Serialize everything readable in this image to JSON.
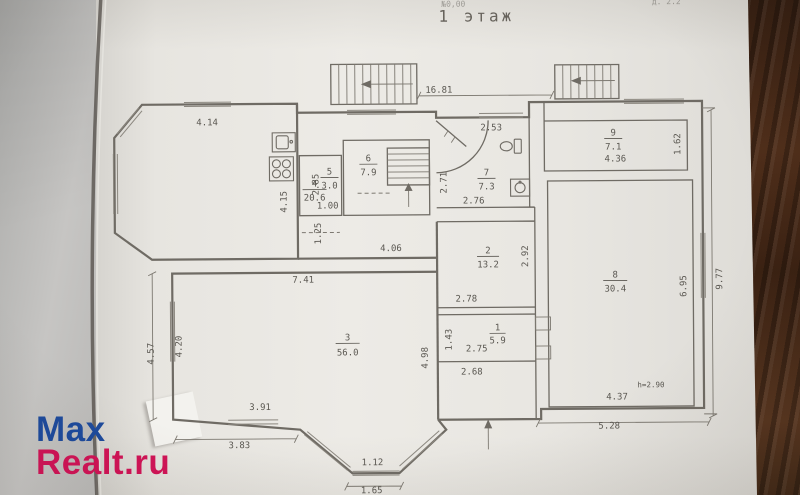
{
  "title": "1 этаж",
  "margin_notes": {
    "left": "№0,00",
    "right": "д. 2.2"
  },
  "watermark": {
    "line1": "Max",
    "line2": "Realt.ru",
    "color_line1": "#1d4a9c",
    "color_line2": "#d01356"
  },
  "colors": {
    "ink": "#5b5852",
    "walls": "#6f6b64",
    "paper": "#eae8e3",
    "wood": "#46281a"
  },
  "plan": {
    "rooms": {
      "r1": {
        "num": "1",
        "area": "5.9"
      },
      "r2": {
        "num": "2",
        "area": "13.2"
      },
      "r3": {
        "num": "3",
        "area": "56.0"
      },
      "r4": {
        "num": "4",
        "area": "20.6"
      },
      "r5": {
        "num": "5",
        "area": "3.0"
      },
      "r6": {
        "num": "6",
        "area": "7.9"
      },
      "r7": {
        "num": "7",
        "area": "7.3"
      },
      "r8": {
        "num": "8",
        "area": "30.4"
      },
      "r9": {
        "num": "9",
        "area": "7.1"
      }
    },
    "dims": {
      "kitchen_window": "4.14",
      "overall_top": "16.81",
      "hall_top": "2.53",
      "hall_left": "2.71",
      "hall_bottom": "2.76",
      "pantry_left": "2.85",
      "pantry_bottom": "1.00",
      "kitchen_right": "4.15",
      "corridor_left": "1.25",
      "corridor_top": "4.06",
      "room2_right": "2.92",
      "room2_bottom": "2.78",
      "room3_top": "7.41",
      "room3_left_inner": "4.20",
      "room3_left_outer": "4.57",
      "room3_right": "4.98",
      "room1_left": "1.43",
      "room1_bottom": "2.75",
      "porch_bottom": "2.68",
      "room3_bottom_inner": "3.91",
      "room3_bottom_outer": "3.83",
      "bay_window_inner": "1.12",
      "bay_window_outer": "1.65",
      "room8_right": "6.95",
      "right_outer": "9.77",
      "room9_bottom": "4.36",
      "room9_right": "1.62",
      "room8_bottom_inner": "4.37",
      "room8_bottom_outer": "5.28",
      "ceiling_height": "h=2.90"
    }
  }
}
